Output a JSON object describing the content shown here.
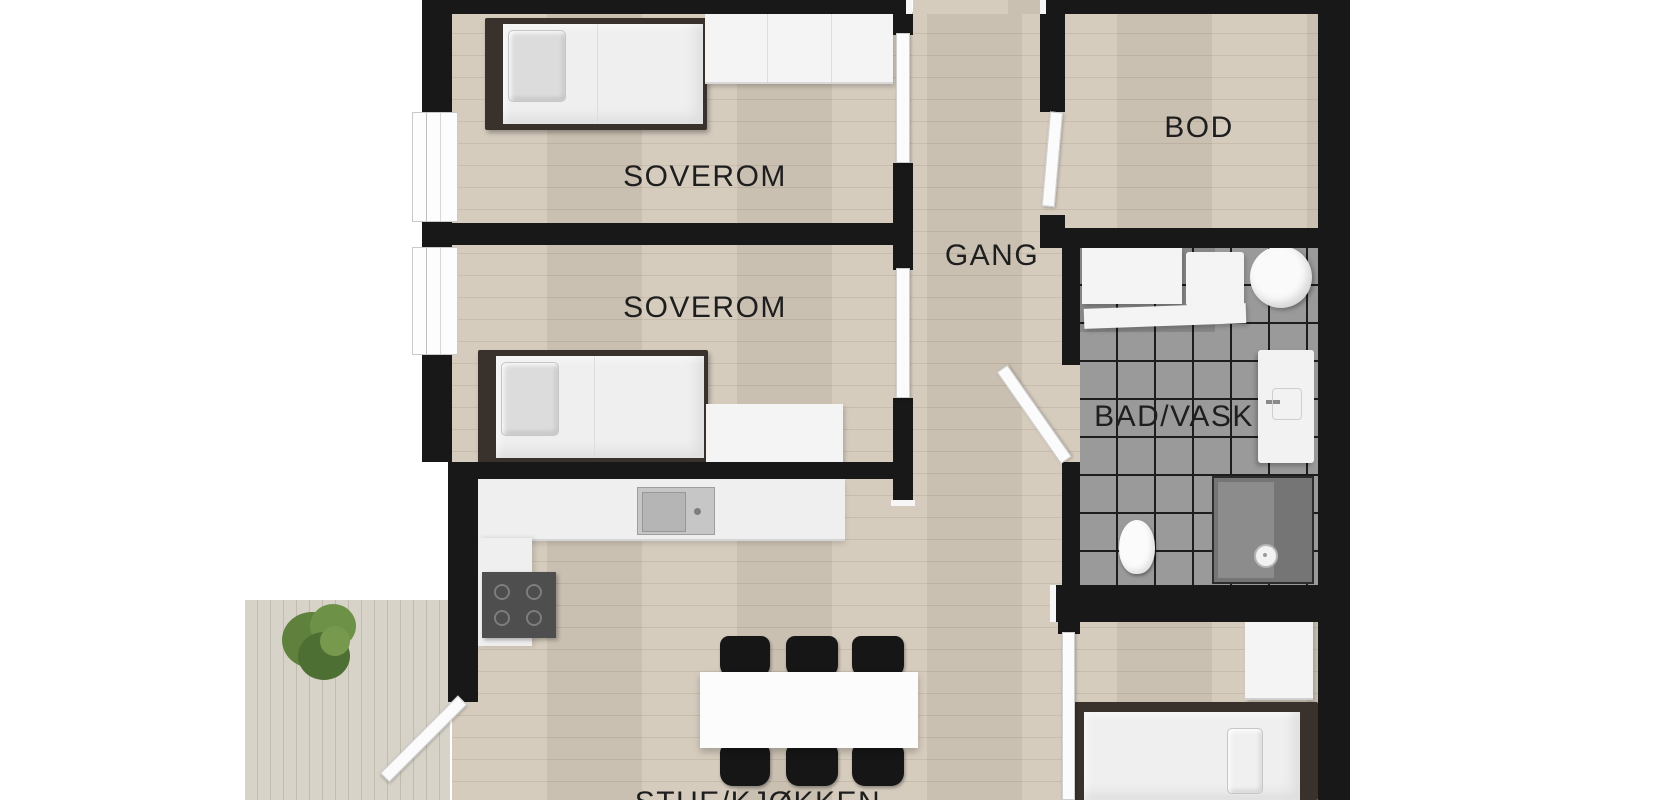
{
  "floorplan": {
    "rooms": [
      {
        "name": "bedroom-1",
        "label": "SOVEROM"
      },
      {
        "name": "bedroom-2",
        "label": "SOVEROM"
      },
      {
        "name": "hallway",
        "label": "GANG"
      },
      {
        "name": "storage",
        "label": "BOD"
      },
      {
        "name": "bathroom",
        "label": "BAD/VASK"
      },
      {
        "name": "living-kitchen",
        "label": "STUE/KJØKKEN"
      }
    ],
    "colors": {
      "wall": "#181818",
      "wood_floor": "#d3c9ba",
      "wood_floor_line": "#c4b9a8",
      "deck": "#d8d3c8",
      "deck_line": "#c2bcaf",
      "tile": "#9a9a9a",
      "tile_grout": "#1d1d1d",
      "furniture_white": "#f4f4f4",
      "bed_frame": "#39322c",
      "chair_black": "#161616",
      "label_text": "#1e1e1e",
      "plant_green": "#5f813d"
    }
  }
}
